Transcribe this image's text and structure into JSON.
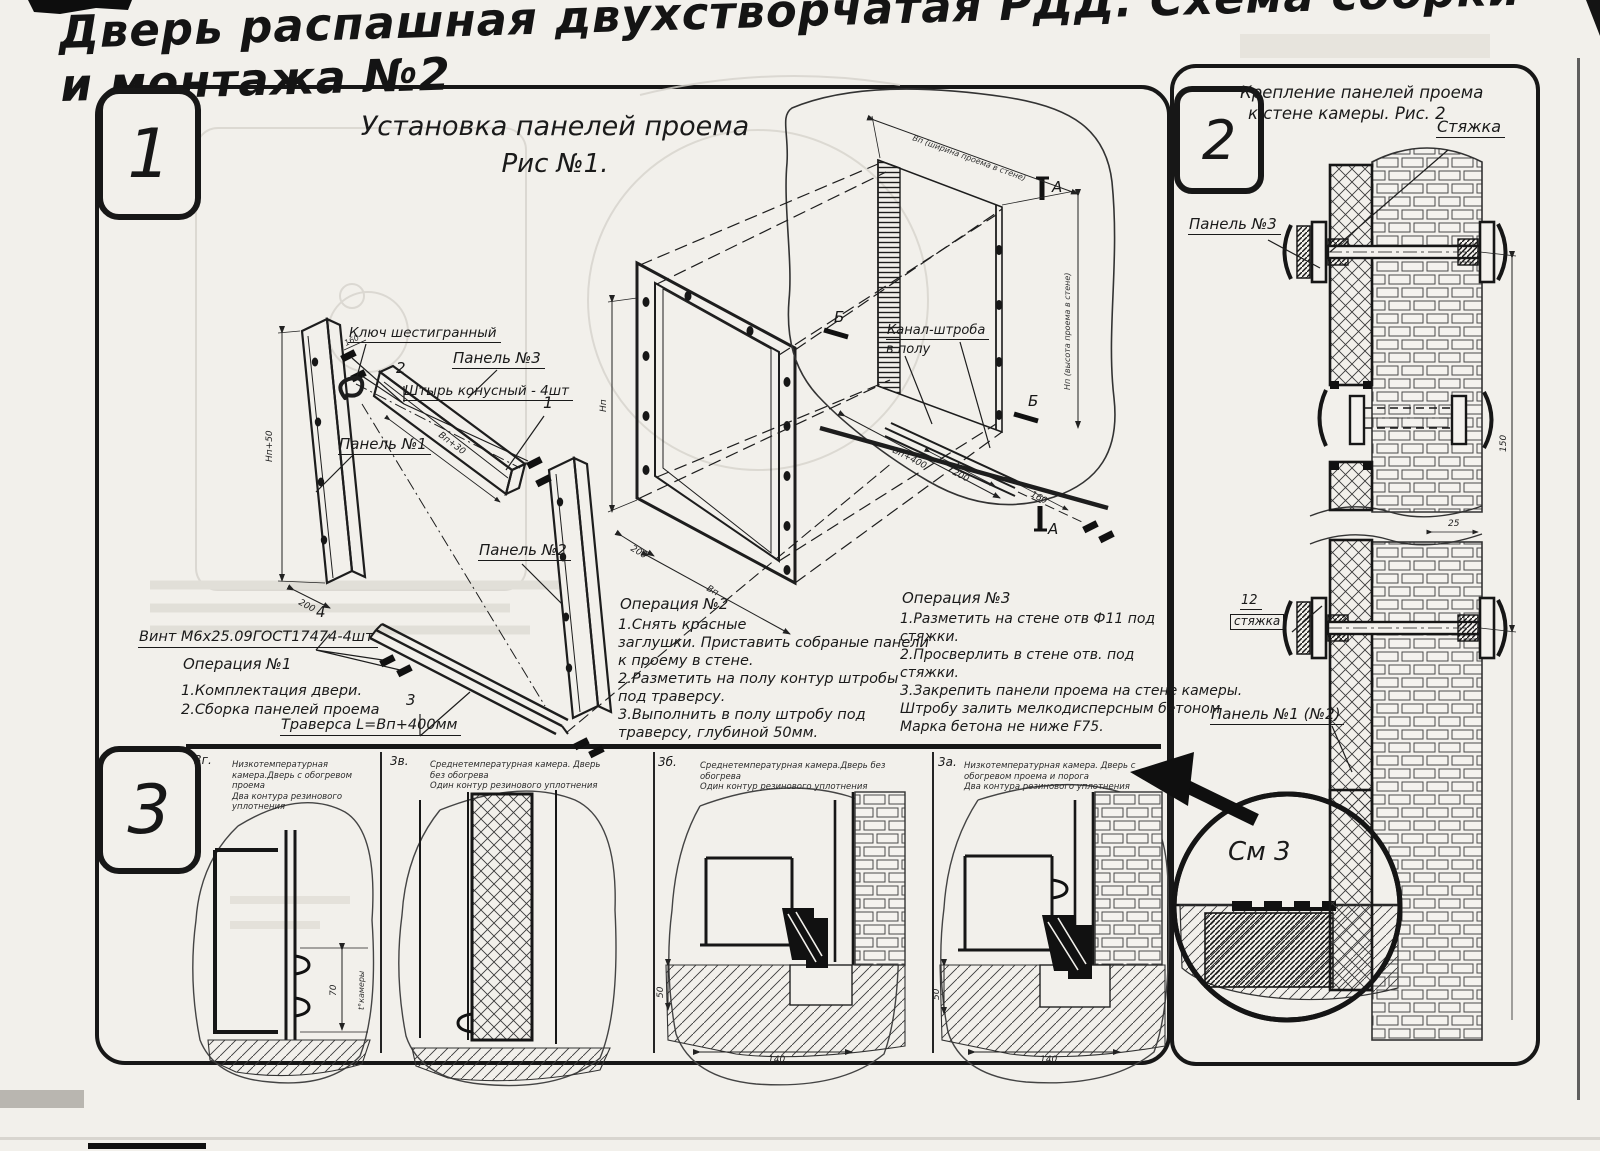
{
  "title": "Дверь распашная двухстворчатая РДД.  Схема сборки и монтажа №2",
  "colors": {
    "ink": "#1a1a1a",
    "paper": "#f2f0eb"
  },
  "fig1": {
    "badge": "1",
    "heading1": "Установка панелей проема",
    "heading2": "Рис №1.",
    "labels": {
      "hex_key": "Ключ шестигранный",
      "pin_no": "2",
      "pin": "Штырь конусный - 4шт",
      "panel3": "Панель №3",
      "panel1": "Панель №1",
      "panel2": "Панель №2",
      "part1": "1",
      "screw_no": "4",
      "screw": "Винт М6х25.09ГОСТ17474-4шт",
      "traverse_no": "3",
      "traverse": "Траверса  L=Вп+400мм",
      "channel1": "Канал-штроба",
      "channel2": "в полу",
      "marker_a": "А",
      "marker_b": "Б"
    },
    "op1": {
      "title": "Операция №1",
      "l1": "1.Комплектация двери.",
      "l2": "2.Сборка панелей проема"
    },
    "op2": {
      "title": "Операция №2",
      "l1": "1.Снять красные",
      "l2": "заглушки. Приставить собраные панели",
      "l3": "к проему в стене.",
      "l4": "2.Разметить на полу контур штробы",
      "l5": "под траверсу.",
      "l6": "3.Выполнить в полу штробу под",
      "l7": "траверсу, глубиной 50мм."
    },
    "op3": {
      "title": "Операция №3",
      "l1": "1.Разметить на стене отв Ф11 под",
      "l2": "стяжки.",
      "l3": "2.Просверлить в стене отв.  под",
      "l4": "стяжки.",
      "l5": "3.Закрепить панели проема на стене камеры.",
      "l6": "Штробу залить мелкодисперсным бетоном",
      "l7": "Марка бетона не ниже  F75."
    },
    "dims": {
      "np50": "Нп+50",
      "n200": "200",
      "vp30": "Вп+30",
      "n160": "160",
      "np": "Нп",
      "vp": "Вп",
      "vp400": "Вп+400",
      "w_full": "Вп (ширина проема в стене)",
      "h_full": "Нп (высота проема в стене)"
    }
  },
  "fig2": {
    "badge": "2",
    "heading1": "Крепление панелей проема",
    "heading2": "к стене камеры. Рис. 2",
    "labels": {
      "tie": "Стяжка",
      "panel3": "Панель №3",
      "pos12": "12",
      "tie2": "стяжка",
      "panel12": "Панель №1 (№2)",
      "see3": "См 3"
    },
    "dims": {
      "n150": "150",
      "n25": "25"
    }
  },
  "fig3": {
    "badge": "3",
    "panels": [
      {
        "id": "3г.",
        "c1": "Низкотемпературная камера.Дверь с обогревом проема",
        "c2": "Два контура резинового уплотнения",
        "d1": "70",
        "d2": "t°камеры"
      },
      {
        "id": "3в.",
        "c1": "Среднетемпературная камера. Дверь без обогрева",
        "c2": "Один контур резинового уплотнения"
      },
      {
        "id": "3б.",
        "c1": "Среднетемпературная камера.Дверь без обогрева",
        "c2": "Один контур резинового уплотнения",
        "d1": "50",
        "d2": "140"
      },
      {
        "id": "3а.",
        "c1": "Низкотемпературная камера. Дверь с обогревом проема и порога",
        "c2": "Два контура резинового уплотнения",
        "d1": "50",
        "d2": "140"
      }
    ]
  }
}
